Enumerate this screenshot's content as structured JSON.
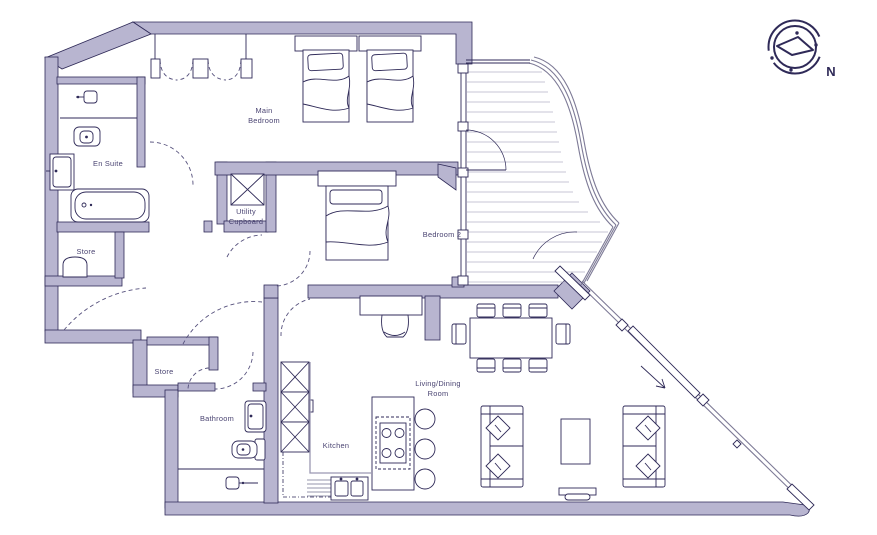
{
  "floorplan": {
    "rooms": {
      "main_bedroom": {
        "line1": "Main",
        "line2": "Bedroom"
      },
      "en_suite": {
        "label": "En Suite"
      },
      "store_upper": {
        "label": "Store"
      },
      "utility_cupboard": {
        "line1": "Utility",
        "line2": "Cupboard"
      },
      "bedroom_2": {
        "label": "Bedroom 2"
      },
      "store_lower": {
        "label": "Store"
      },
      "bathroom": {
        "label": "Bathroom"
      },
      "kitchen": {
        "label": "Kitchen"
      },
      "living_dining": {
        "line1": "Living/Dining",
        "line2": "Room"
      }
    },
    "compass": {
      "north_label": "N"
    },
    "colors": {
      "wall_fill": "#b8b5d0",
      "line": "#2f2a58",
      "label_text": "#4a4472",
      "counter_line": "#9b98b2",
      "decking_line": "#b5b3c6",
      "railing_line": "#7d7a96",
      "background": "#ffffff"
    }
  }
}
